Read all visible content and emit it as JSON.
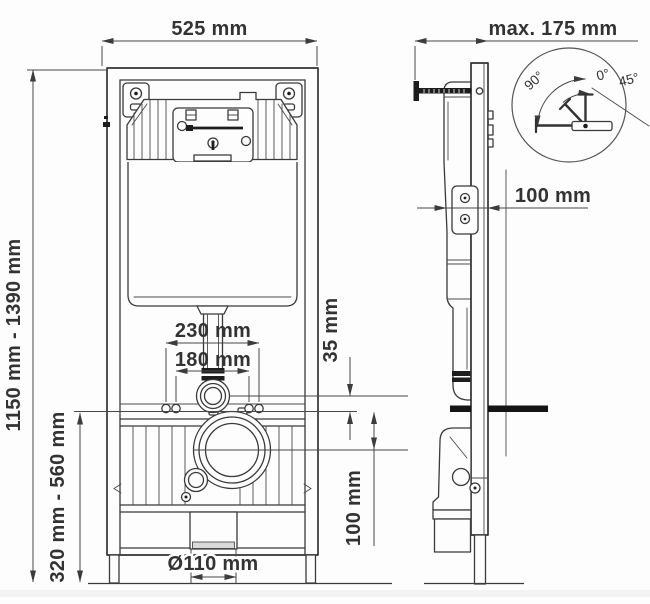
{
  "front_view": {
    "frame_width": "525 mm",
    "frame_height": "1150 mm - 1390 mm",
    "outlet_height": "320 mm - 560 mm",
    "flush_pipe_width": "230 mm",
    "stud_width": "180 mm",
    "flush_offset": "35 mm",
    "outlet_offset": "100 mm",
    "outlet_diameter": "Ø110 mm"
  },
  "side_view": {
    "wall_distance": "max. 175 mm",
    "bracket_depth": "100 mm"
  },
  "detail": {
    "angle_90": "90°",
    "angle_0": "0°",
    "angle_45": "45°"
  },
  "colors": {
    "ink": "#3a3a3a",
    "background": "#fdfdfd",
    "stud_bar": "#151515"
  }
}
